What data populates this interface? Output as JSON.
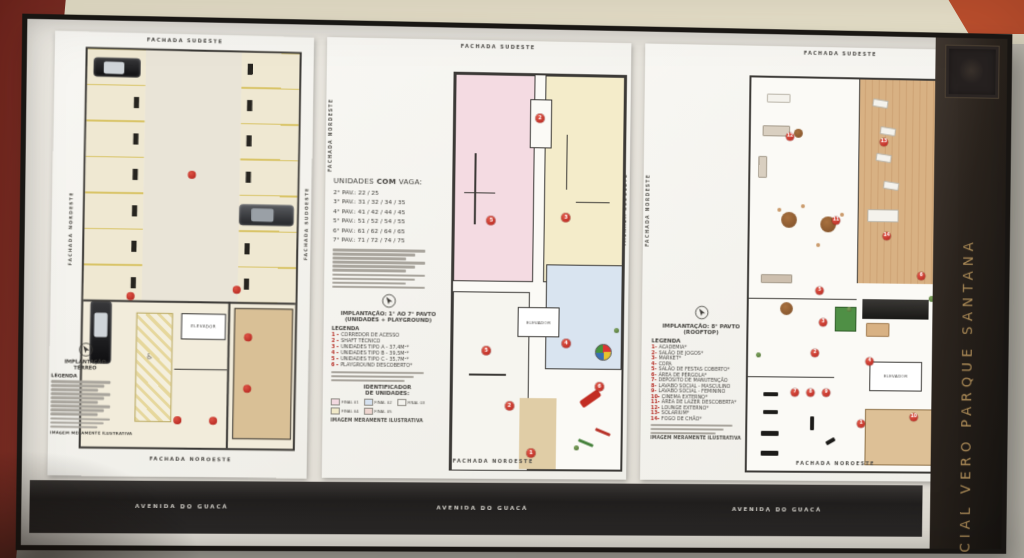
{
  "board": {
    "brand_vertical_text": "CIAL VERO PARQUE SANTANA",
    "street_label": "AVENIDA DO GUACÁ",
    "facade_top": "FACHADA SUDESTE",
    "facade_bottom": "FACHADA NOROESTE",
    "facade_left": "FACHADA NORDESTE",
    "facade_right": "FACHADA SUDOESTE",
    "disclaimer": "IMAGEM MERAMENTE ILUSTRATIVA",
    "elevator_label": "ELEVADOR",
    "accent_red": "#b3251d",
    "brand_gold": "#ad8c58"
  },
  "left_panel": {
    "title_line1": "IMPLANTAÇÃO",
    "title_line2": "TÉRREO",
    "legend_heading": "LEGENDA",
    "markers": [
      {
        "x": 50,
        "y": 31
      },
      {
        "x": 22,
        "y": 62
      },
      {
        "x": 72,
        "y": 60
      },
      {
        "x": 78,
        "y": 72
      },
      {
        "x": 78,
        "y": 85
      },
      {
        "x": 62,
        "y": 93
      },
      {
        "x": 45,
        "y": 93
      }
    ]
  },
  "middle_panel": {
    "units_heading_pre": "UNIDADES ",
    "units_heading_bold": "COM",
    "units_heading_post": " VAGA:",
    "pav_list": [
      "2° PAV.: 22 / 25",
      "3° PAV.: 31 / 32 / 34 / 35",
      "4° PAV.: 41 / 42 / 44 / 45",
      "5° PAV.: 51 / 52 / 54 / 55",
      "6° PAV.: 61 / 62 / 64 / 65",
      "7° PAV.: 71 / 72 / 74 / 75"
    ],
    "title": "IMPLANTAÇÃO: 1° AO 7° PAVTO",
    "subtitle": "(UNIDADES + PLAYGROUND)",
    "legend_heading": "LEGENDA",
    "legend": [
      {
        "n": "1 -",
        "t": "CORREDOR DE ACESSO"
      },
      {
        "n": "2 -",
        "t": "SHAFT TÉCNICO"
      },
      {
        "n": "3 -",
        "t": "UNIDADES TIPO A - 37,4M²*"
      },
      {
        "n": "4 -",
        "t": "UNIDADES TIPO B - 39,5M²*"
      },
      {
        "n": "5 -",
        "t": "UNIDADES TIPO C - 35,7M²*"
      },
      {
        "n": "6 -",
        "t": "PLAYGROUND DESCOBERTO*"
      }
    ],
    "identifier_line1": "IDENTIFICADOR",
    "identifier_line2": "DE UNIDADES:",
    "finals": [
      {
        "label": "FINAL 01",
        "color": "#f3d9e0"
      },
      {
        "label": "FINAL 02",
        "color": "#d5e1ef"
      },
      {
        "label": "FINAL 03",
        "color": "#f4f3ee"
      },
      {
        "label": "FINAL 04",
        "color": "#f1e9c8"
      },
      {
        "label": "FINAL 05",
        "color": "#eed5cf"
      }
    ],
    "markers": [
      {
        "n": "2",
        "x": 50,
        "y": 11
      },
      {
        "n": "5",
        "x": 22,
        "y": 37
      },
      {
        "n": "3",
        "x": 66,
        "y": 36
      },
      {
        "n": "5",
        "x": 20,
        "y": 70
      },
      {
        "n": "4",
        "x": 67,
        "y": 68
      },
      {
        "n": "2",
        "x": 34,
        "y": 84
      },
      {
        "n": "1",
        "x": 47,
        "y": 96
      },
      {
        "n": "6",
        "x": 87,
        "y": 79
      }
    ]
  },
  "right_panel": {
    "title": "IMPLANTAÇÃO: 8° PAVTO",
    "subtitle": "(ROOFTOP)",
    "legend_heading": "LEGENDA",
    "legend": [
      {
        "n": "1-",
        "t": "ACADEMIA*"
      },
      {
        "n": "2-",
        "t": "SALÃO DE JOGOS*"
      },
      {
        "n": "3-",
        "t": "MARKET*"
      },
      {
        "n": "4-",
        "t": "COPA"
      },
      {
        "n": "5-",
        "t": "SALÃO DE FESTAS COBERTO*"
      },
      {
        "n": "6-",
        "t": "ÁREA DE PÉRGOLA*"
      },
      {
        "n": "7-",
        "t": "DEPÓSITO DE MANUTENÇÃO"
      },
      {
        "n": "8-",
        "t": "LAVABO SOCIAL - MASCULINO"
      },
      {
        "n": "9-",
        "t": "LAVABO SOCIAL - FEMININO"
      },
      {
        "n": "10-",
        "t": "CINEMA EXTERNO*"
      },
      {
        "n": "11-",
        "t": "ÁREA DE LAZER DESCOBERTA*"
      },
      {
        "n": "12-",
        "t": "LOUNGE EXTERNO*"
      },
      {
        "n": "13-",
        "t": "SOLARIUM*"
      },
      {
        "n": "14-",
        "t": "FOGO DE CHÃO*"
      }
    ],
    "markers": [
      {
        "n": "12",
        "x": 20,
        "y": 15
      },
      {
        "n": "13",
        "x": 68,
        "y": 16
      },
      {
        "n": "11",
        "x": 44,
        "y": 36
      },
      {
        "n": "14",
        "x": 70,
        "y": 40
      },
      {
        "n": "5",
        "x": 36,
        "y": 54
      },
      {
        "n": "6",
        "x": 88,
        "y": 50
      },
      {
        "n": "3",
        "x": 38,
        "y": 62
      },
      {
        "n": "2",
        "x": 34,
        "y": 70
      },
      {
        "n": "4",
        "x": 62,
        "y": 72
      },
      {
        "n": "7",
        "x": 24,
        "y": 80
      },
      {
        "n": "8",
        "x": 32,
        "y": 80
      },
      {
        "n": "9",
        "x": 40,
        "y": 80
      },
      {
        "n": "1",
        "x": 58,
        "y": 88
      },
      {
        "n": "10",
        "x": 85,
        "y": 86
      }
    ]
  }
}
